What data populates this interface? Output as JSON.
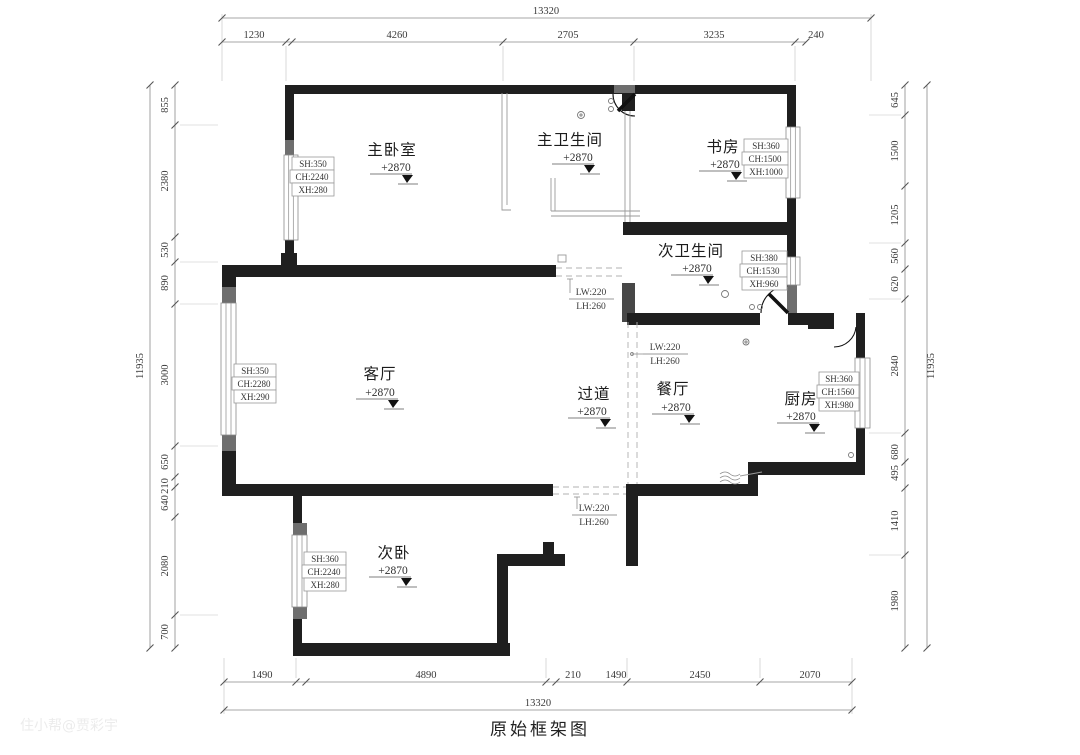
{
  "title": "原始框架图",
  "watermark": "住小帮@贾彩宇",
  "colors": {
    "wall": "#1f1f1f",
    "dim_line": "#8a8a8a",
    "text": "#2e2e2e",
    "accent_gray": "#6e6e6e"
  },
  "dims": {
    "top_total": "13320",
    "top": [
      "1230",
      "4260",
      "2705",
      "3235",
      "240"
    ],
    "bottom": [
      "1490",
      "4890",
      "210",
      "1490",
      "2450",
      "2070"
    ],
    "bottom_total": "13320",
    "left": [
      "855",
      "2380",
      "530",
      "890",
      "3000",
      "650",
      "210",
      "640",
      "2080",
      "700"
    ],
    "left_total": "11935",
    "right": [
      "645",
      "1500",
      "1205",
      "560",
      "620",
      "2840",
      "680",
      "495",
      "1410",
      "1980"
    ],
    "right_total": "11935"
  },
  "rooms": [
    {
      "id": "master-bedroom",
      "name": "主卧室",
      "elevation": "+2870"
    },
    {
      "id": "master-bathroom",
      "name": "主卫生间",
      "elevation": "+2870"
    },
    {
      "id": "study",
      "name": "书房",
      "elevation": "+2870"
    },
    {
      "id": "second-bathroom",
      "name": "次卫生间",
      "elevation": "+2870"
    },
    {
      "id": "living-room",
      "name": "客厅",
      "elevation": "+2870"
    },
    {
      "id": "hallway",
      "name": "过道",
      "elevation": "+2870"
    },
    {
      "id": "dining-room",
      "name": "餐厅",
      "elevation": "+2870"
    },
    {
      "id": "kitchen",
      "name": "厨房",
      "elevation": "+2870"
    },
    {
      "id": "second-bedroom",
      "name": "次卧",
      "elevation": "+2870"
    }
  ],
  "windows": [
    {
      "room": "主卧室",
      "rows": [
        "SH:350",
        "CH:2240",
        "XH:280"
      ]
    },
    {
      "room": "书房",
      "rows": [
        "SH:360",
        "CH:1500",
        "XH:1000"
      ]
    },
    {
      "room": "次卫生间",
      "rows": [
        "SH:380",
        "CH:1530",
        "XH:960"
      ]
    },
    {
      "room": "客厅",
      "rows": [
        "SH:350",
        "CH:2280",
        "XH:290"
      ]
    },
    {
      "room": "厨房",
      "rows": [
        "SH:360",
        "CH:1560",
        "XH:980"
      ]
    },
    {
      "room": "次卧",
      "rows": [
        "SH:360",
        "CH:2240",
        "XH:280"
      ]
    }
  ],
  "openings": [
    {
      "lw": "LW:220",
      "lh": "LH:260"
    },
    {
      "lw": "LW:220",
      "lh": "LH:260"
    },
    {
      "lw": "LW:220",
      "lh": "LH:260"
    }
  ]
}
